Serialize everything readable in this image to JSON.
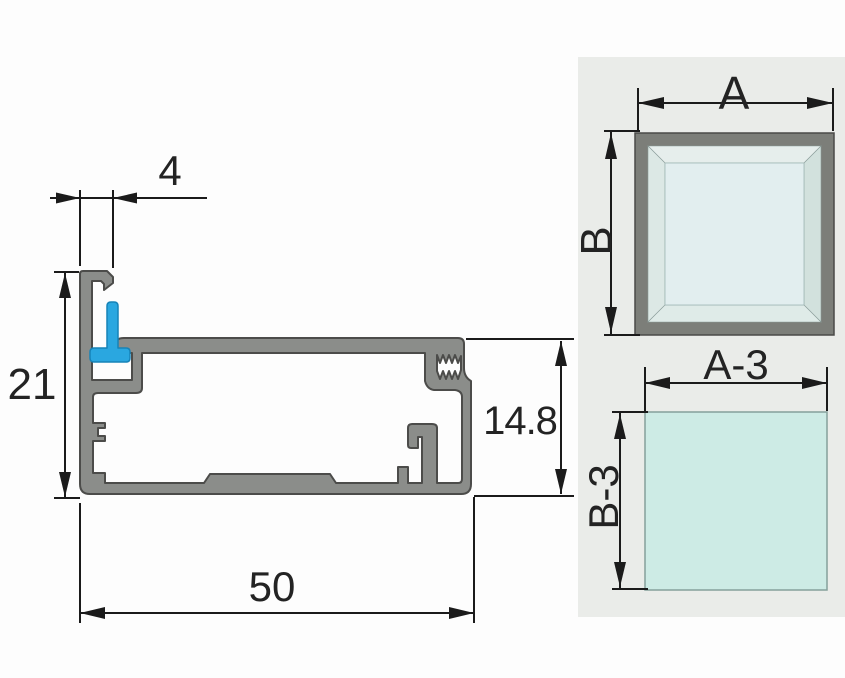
{
  "drawing": {
    "title": "aluminium-profile-cross-section",
    "dims": {
      "top_width": "4",
      "left_height": "21",
      "right_height": "14.8",
      "bottom_width": "50"
    }
  },
  "panel": {
    "outer_width_label": "A",
    "outer_height_label": "B",
    "glass_width_label": "A-3",
    "glass_height_label": "B-3"
  },
  "colors": {
    "profile_gray": "#8b8d8a",
    "profile_outline": "#4c4c4a",
    "gasket_blue": "#2aa7e0",
    "gasket_outline": "#1683b8",
    "panel_bg": "#eaece9",
    "frame_gray": "#7c7e79",
    "glass_pane": "#e2eeef",
    "glass_sheet": "#cdebe5",
    "line_black": "#1b1b1b"
  }
}
